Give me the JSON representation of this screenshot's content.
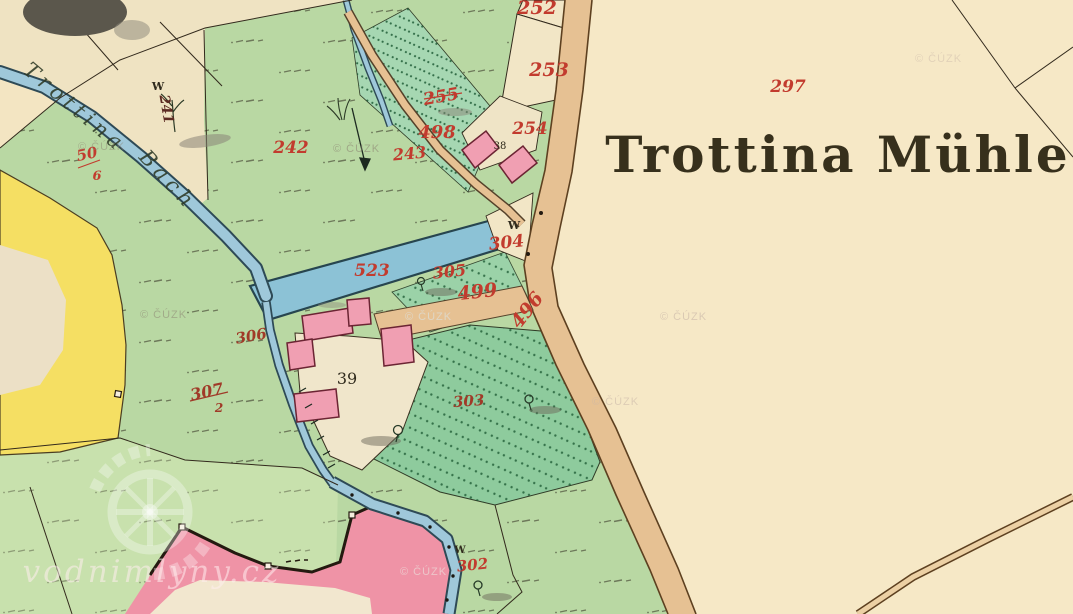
{
  "map": {
    "title": "Trottina Mühle",
    "stream_name_part1": "Trottina",
    "stream_name_part2": "Bach",
    "meadow_letter": "W",
    "parcel_labels": {
      "p252": "252",
      "p253": "253",
      "p255": "255",
      "p498": "498",
      "p254": "254",
      "p243": "243",
      "p242": "242",
      "p241": "241",
      "p297": "297",
      "p304": "304",
      "p523": "523",
      "p305": "305",
      "p499": "499",
      "p496": "496",
      "p306": "306",
      "p307_num": "307",
      "p307_den": "2",
      "p50_num": "50",
      "p50_den": "6",
      "p303": "303",
      "p302": "302"
    },
    "building_labels": {
      "b38": "38",
      "b39": "39"
    },
    "watermarks": {
      "site": "vodnimlyny.cz",
      "cuzk": "© ČÚZK"
    },
    "colors": {
      "paper": "#f3e5c2",
      "meadow_green": "#b9d8a3",
      "garden_green": "#8ecb9d",
      "water_blue": "#9fc8da",
      "road_tan": "#e6c193",
      "building_pink": "#f09fb2",
      "village_pink": "#ef93a6",
      "field_yellow": "#f5df63",
      "label_red": "#c23b2e"
    }
  }
}
